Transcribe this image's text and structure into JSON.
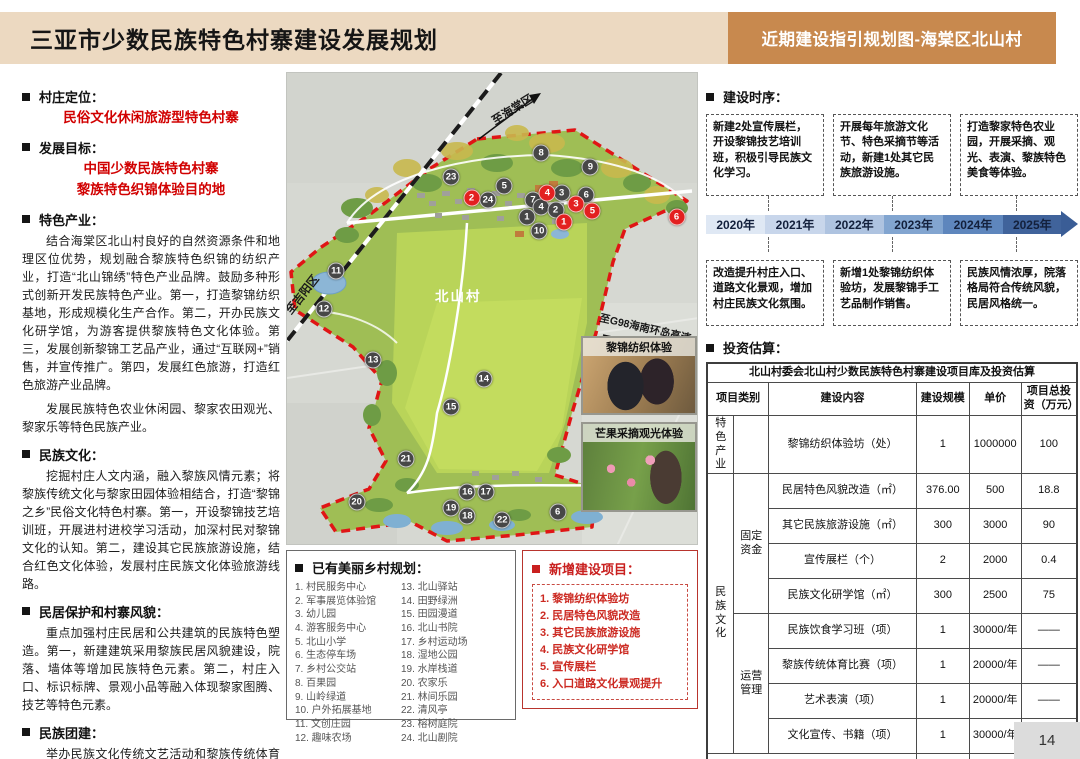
{
  "header": {
    "title": "三亚市少数民族特色村寨建设发展规划",
    "tag": "近期建设指引规划图-海棠区北山村"
  },
  "left_panel": {
    "sections": [
      {
        "label": "村庄定位：",
        "red_lines": [
          "民俗文化休闲旅游型特色村寨"
        ],
        "paragraphs": []
      },
      {
        "label": "发展目标：",
        "red_lines": [
          "中国少数民族特色村寨",
          "黎族特色织锦体验目的地"
        ],
        "paragraphs": []
      },
      {
        "label": "特色产业：",
        "red_lines": [],
        "paragraphs": [
          "结合海棠区北山村良好的自然资源条件和地理区位优势，规划融合黎族特色织锦的纺织产业，打造“北山锦绣”特色产业品牌。鼓励多种形式创新开发民族特色产业。第一，打造黎锦纺织基地，形成规模化生产合作。第二，开办民族文化研学馆，为游客提供黎族特色文化体验。第三，发展创新黎锦工艺品产业，通过“互联网+”销售，并宣传推广。第四，发展红色旅游，打造红色旅游产业品牌。",
          "发展民族特色农业休闲园、黎家农田观光、黎家乐等特色民族产业。"
        ]
      },
      {
        "label": "民族文化：",
        "red_lines": [],
        "paragraphs": [
          "挖掘村庄人文内涵，融入黎族风情元素；将黎族传统文化与黎家田园体验相结合，打造“黎锦之乡”民俗文化特色村寨。第一，开设黎锦技艺培训班，开展进村进校学习活动，加深村民对黎锦文化的认知。第二，建设其它民族旅游设施，结合红色文化体验，发展村庄民族文化体验旅游线路。"
        ]
      },
      {
        "label": "民居保护和村寨风貌：",
        "red_lines": [],
        "paragraphs": [
          "重点加强村庄民居和公共建筑的民族特色塑造。第一，新建建筑采用黎族民居风貌建设，院落、墙体等增加民族特色元素。第二，村庄入口、标识标牌、景观小品等融入体现黎家图腾、技艺等特色元素。"
        ]
      },
      {
        "label": "民族团建：",
        "red_lines": [],
        "paragraphs": [
          "举办民族文化传统文艺活动和黎族传统体育赛事，加强文化宣传，发展文化体验旅游业。"
        ]
      }
    ]
  },
  "map": {
    "village_name": "北山村",
    "road_labels": {
      "haitang": "至海棠区",
      "jiyang": "至吉阳区",
      "g98": "至G98海南环岛高速"
    },
    "photos": [
      {
        "label": "黎锦纺织体验"
      },
      {
        "label": "芒果采摘观光体验"
      }
    ],
    "gray_markers": [
      {
        "n": "8",
        "x": 62,
        "y": 17
      },
      {
        "n": "9",
        "x": 74,
        "y": 20
      },
      {
        "n": "23",
        "x": 40,
        "y": 22
      },
      {
        "n": "5",
        "x": 53,
        "y": 24
      },
      {
        "n": "24",
        "x": 49,
        "y": 27
      },
      {
        "n": "7",
        "x": 60,
        "y": 27
      },
      {
        "n": "3",
        "x": 67,
        "y": 25.5
      },
      {
        "n": "6",
        "x": 73,
        "y": 26
      },
      {
        "n": "4",
        "x": 62,
        "y": 28.5
      },
      {
        "n": "2",
        "x": 65.5,
        "y": 29
      },
      {
        "n": "1",
        "x": 58.5,
        "y": 30.5
      },
      {
        "n": "10",
        "x": 61.5,
        "y": 33.5
      },
      {
        "n": "11",
        "x": 12,
        "y": 42
      },
      {
        "n": "12",
        "x": 9,
        "y": 50
      },
      {
        "n": "13",
        "x": 21,
        "y": 61
      },
      {
        "n": "14",
        "x": 48,
        "y": 65
      },
      {
        "n": "15",
        "x": 40,
        "y": 71
      },
      {
        "n": "21",
        "x": 29,
        "y": 82
      },
      {
        "n": "20",
        "x": 17,
        "y": 91
      },
      {
        "n": "16",
        "x": 44,
        "y": 89
      },
      {
        "n": "17",
        "x": 48.5,
        "y": 89
      },
      {
        "n": "19",
        "x": 40,
        "y": 92.3
      },
      {
        "n": "18",
        "x": 44,
        "y": 94
      },
      {
        "n": "22",
        "x": 52.5,
        "y": 95
      },
      {
        "n": "6",
        "x": 66,
        "y": 93.2
      }
    ],
    "red_markers": [
      {
        "n": "1",
        "x": 67.5,
        "y": 31.7
      },
      {
        "n": "2",
        "x": 45,
        "y": 26.5
      },
      {
        "n": "3",
        "x": 70.5,
        "y": 27.8
      },
      {
        "n": "4",
        "x": 63.5,
        "y": 25.5
      },
      {
        "n": "5",
        "x": 74.5,
        "y": 29.3
      },
      {
        "n": "6",
        "x": 95,
        "y": 30.5
      }
    ]
  },
  "legend": {
    "title": "已有美丽乡村规划：",
    "col1": [
      "村民服务中心",
      "军事展览体验馆",
      "幼儿园",
      "游客服务中心",
      "北山小学",
      "生态停车场",
      "乡村公交站",
      "百果园",
      "山岭绿道",
      "户外拓展基地",
      "文创庄园",
      "趣味农场"
    ],
    "col2": [
      "北山驿站",
      "田野绿洲",
      "田园漫道",
      "北山书院",
      "乡村运动场",
      "湿地公园",
      "水岸栈道",
      "农家乐",
      "林间乐园",
      "清风亭",
      "榕树庭院",
      "北山剧院"
    ]
  },
  "new_projects": {
    "title": "新增建设项目：",
    "items": [
      "黎锦纺织体验坊",
      "民居特色风貌改造",
      "其它民族旅游设施",
      "民族文化研学馆",
      "宣传展栏",
      "入口道路文化景观提升"
    ]
  },
  "timeline": {
    "title": "建设时序：",
    "top_boxes": [
      "新建2处宣传展栏，开设黎锦技艺培训班，积极引导民族文化学习。",
      "开展每年旅游文化节、特色采摘节等活动，新建1处其它民族旅游设施。",
      "打造黎家特色农业园，开展采摘、观光、表演、黎族特色美食等体验。"
    ],
    "bottom_boxes": [
      "改造提升村庄入口、道路文化景观，增加村庄民族文化氛围。",
      "新增1处黎锦纺织体验坊，发展黎锦手工艺品制作销售。",
      "民族风情浓厚，院落格局符合传统风貌，民居风格统一。"
    ],
    "years": [
      {
        "label": "2020年",
        "color": "#dfe8f4"
      },
      {
        "label": "2021年",
        "color": "#c8d6eb"
      },
      {
        "label": "2022年",
        "color": "#aec3e0"
      },
      {
        "label": "2023年",
        "color": "#82a5d0"
      },
      {
        "label": "2024年",
        "color": "#5e86bd"
      },
      {
        "label": "2025年",
        "color": "#40639b"
      }
    ]
  },
  "investment": {
    "title": "投资估算：",
    "table_title": "北山村委会北山村少数民族特色村寨建设项目库及投资估算",
    "headers": [
      "项目类别",
      "建设内容",
      "建设规模",
      "单价",
      "项目总投资（万元）"
    ],
    "rows": [
      {
        "cat1": "特色产业",
        "cat1Span": 1,
        "cat2": "",
        "cat2Span": 1,
        "content": "黎锦纺织体验坊（处）",
        "scale": "1",
        "price": "1000000",
        "total": "100"
      },
      {
        "cat1": "民族文化",
        "cat1Span": 8,
        "cat2": "固定资金",
        "cat2Span": 4,
        "content": "民居特色风貌改造（㎡）",
        "scale": "376.00",
        "price": "500",
        "total": "18.8"
      },
      {
        "content": "其它民族旅游设施（㎡）",
        "scale": "300",
        "price": "3000",
        "total": "90"
      },
      {
        "content": "宣传展栏（个）",
        "scale": "2",
        "price": "2000",
        "total": "0.4"
      },
      {
        "content": "民族文化研学馆（㎡）",
        "scale": "300",
        "price": "2500",
        "total": "75"
      },
      {
        "cat2": "运营管理",
        "cat2Span": 4,
        "content": "民族饮食学习班（项）",
        "scale": "1",
        "price": "30000/年",
        "total": "——"
      },
      {
        "content": "黎族传统体育比赛（项）",
        "scale": "1",
        "price": "20000/年",
        "total": "——"
      },
      {
        "content": "艺术表演（项）",
        "scale": "1",
        "price": "20000/年",
        "total": "——"
      },
      {
        "content": "文化宣传、书籍（项）",
        "scale": "1",
        "price": "30000/年",
        "total": "——"
      }
    ],
    "total_label": "合计",
    "total_value": "284.20"
  },
  "footer": {
    "page": "14"
  }
}
